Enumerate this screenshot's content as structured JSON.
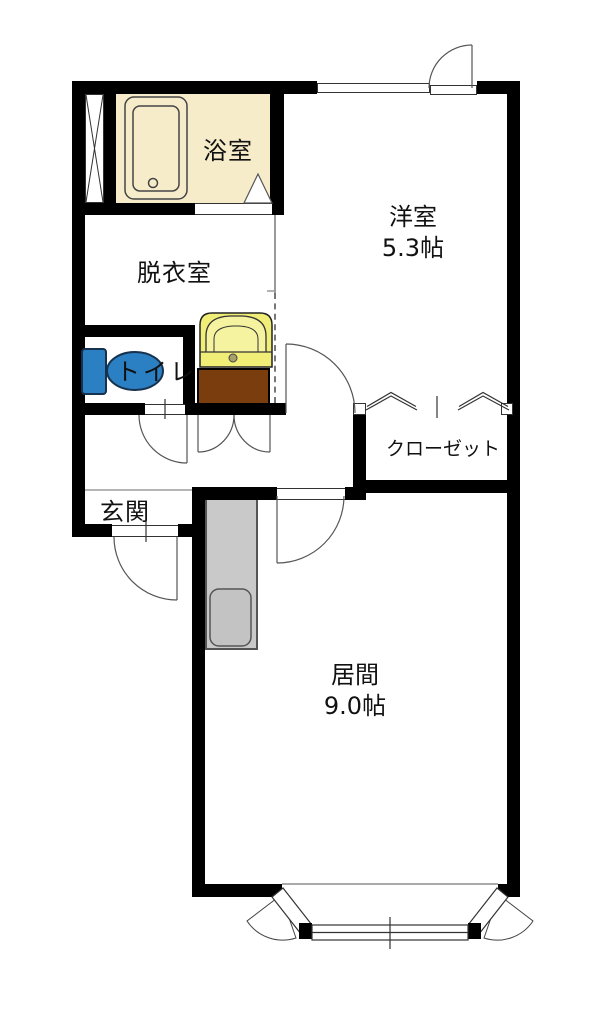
{
  "plan": {
    "type": "apartment-floor-plan",
    "rooms": {
      "bathroom": {
        "label": "浴室"
      },
      "dressing_room": {
        "label": "脱衣室"
      },
      "toilet": {
        "label": "トイレ"
      },
      "western_room": {
        "label": "洋室",
        "size": "5.3帖"
      },
      "closet": {
        "label": "クローゼット"
      },
      "entrance": {
        "label": "玄関"
      },
      "living_room": {
        "label": "居間",
        "size": "9.0帖"
      }
    },
    "fixtures": [
      "pipe-shaft",
      "bathtub",
      "washbasin",
      "washing-machine-space",
      "toilet-fixture",
      "kitchen-counter",
      "kitchen-sink",
      "bay-window",
      "sliding-window",
      "closet-folding-doors"
    ],
    "colors": {
      "wall": "#000000",
      "bathroom_floor": "#f6ecca",
      "washbasin": "#f1ee78",
      "washing_machine_space": "#7a3d0e",
      "toilet_fixture": "#2b7fc3",
      "kitchen_counter": "#c9c9c9",
      "line": "#333333"
    }
  }
}
